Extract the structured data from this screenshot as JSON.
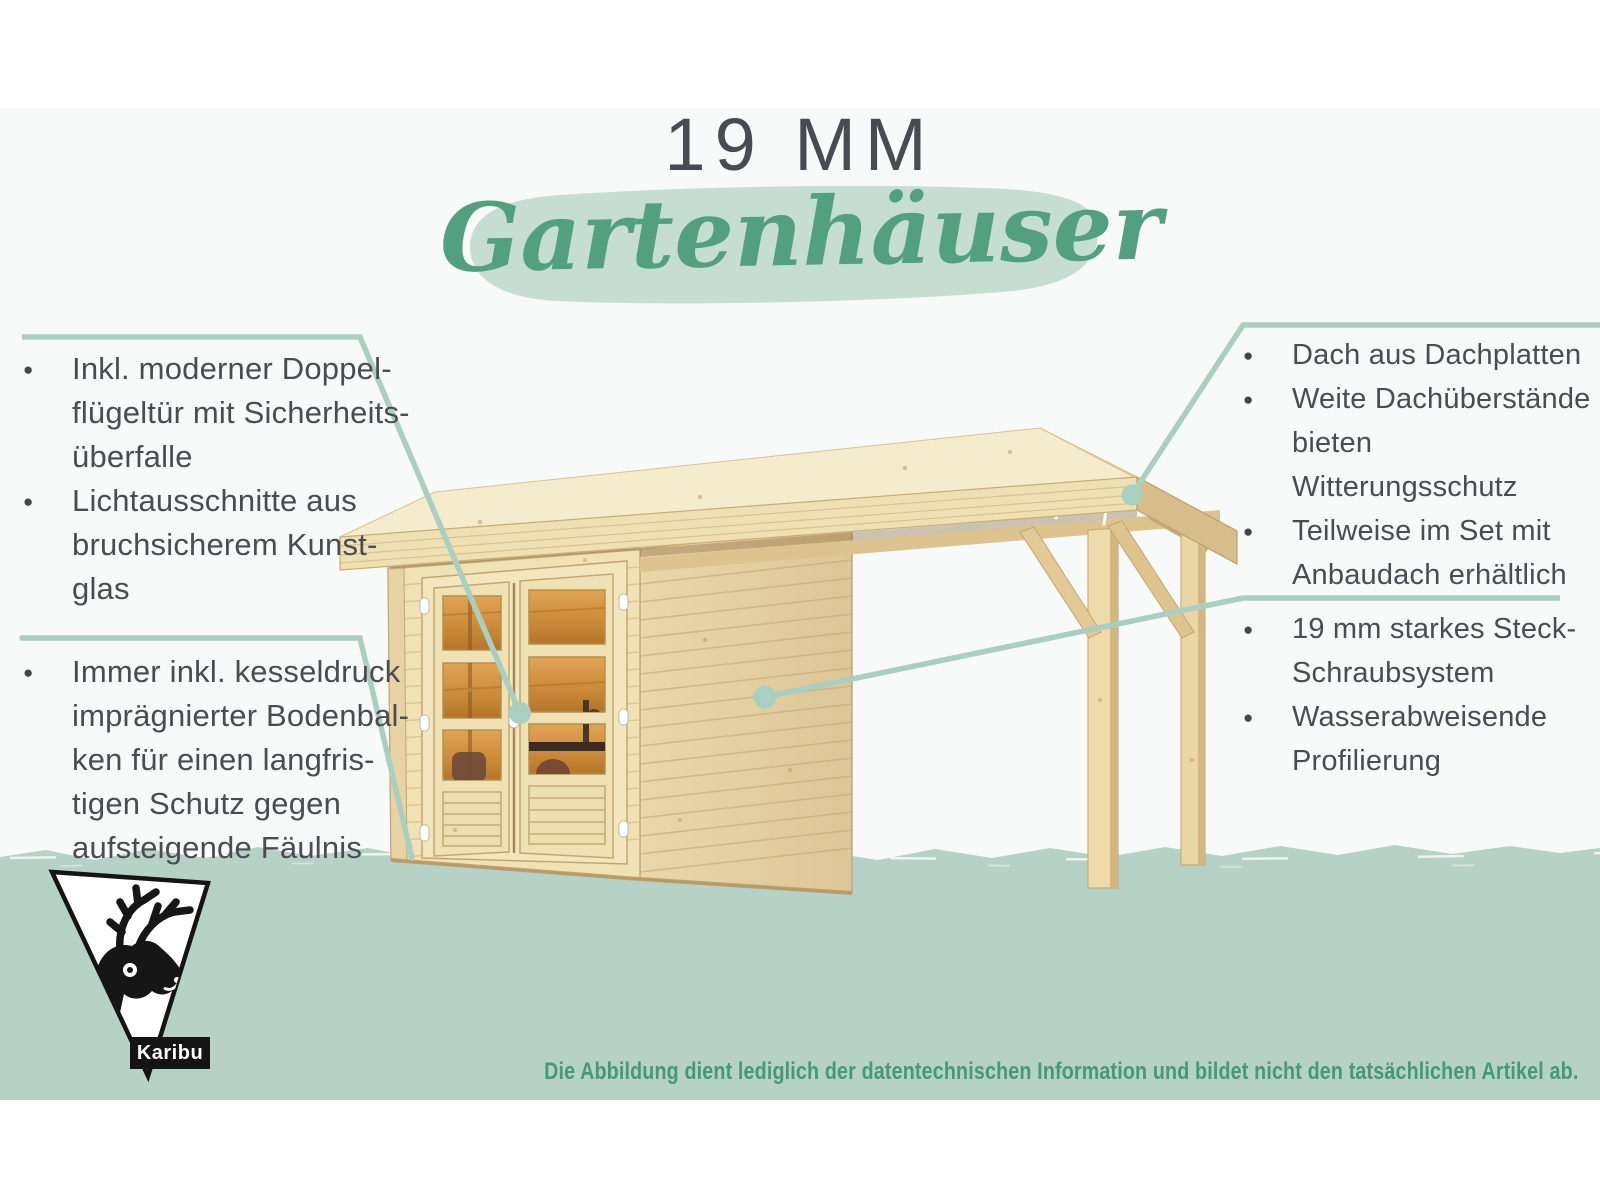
{
  "header": {
    "size_label": "19 MM",
    "title_script": "Gartenhäuser"
  },
  "callouts": {
    "top_left": {
      "items": [
        "Inkl. moderner Doppel-\nflügeltür mit Sicherheits-\nüberfalle",
        "Lichtausschnitte aus\nbruchsicherem Kunst-\nglas"
      ]
    },
    "bottom_left": {
      "items": [
        "Immer inkl. kesseldruck\nimprägnierter Bodenbal-\nken für einen langfris-\ntigen Schutz gegen\naufsteigende Fäulnis"
      ]
    },
    "top_right": {
      "items": [
        "Dach aus Dachplatten",
        "Weite Dachüberstände\nbieten Witterungsschutz",
        "Teilweise im Set mit\nAnbaudach erhältlich"
      ]
    },
    "bottom_right": {
      "items": [
        "19 mm starkes Steck-\nSchraubsystem",
        "Wasserabweisende\nProfilierung"
      ]
    }
  },
  "footer": {
    "disclaimer": "Die Abbildung dient lediglich der datentechnischen Information und bildet nicht den tatsächlichen Artikel ab."
  },
  "logo": {
    "brand": "Karibu"
  },
  "illustration": {
    "alt": "Gartenhaus aus naturbelassenem Holz mit Doppelflügeltür und Anbaudach"
  },
  "colors": {
    "script_green": "#53a081",
    "title_brush": "#c6ddd1",
    "ground_band": "#b6d1c5",
    "callout_line": "#a9cfc0",
    "text_dark": "#4b4b54",
    "disclaimer_green": "#459878",
    "wood_light": "#f3e4ba",
    "wood_mid": "#e6d2a6",
    "glass_warm": "#c98a3e"
  }
}
